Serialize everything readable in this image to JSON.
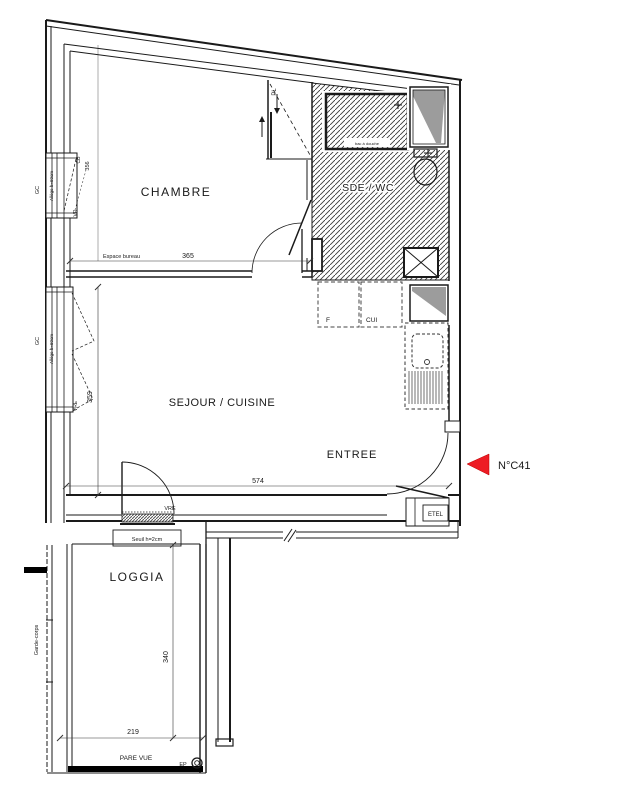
{
  "unit": {
    "arrow_label": "N°C41",
    "arrow_color": "#ed1c24"
  },
  "rooms": {
    "chambre": "CHAMBRE",
    "sde_wc": "SDE / WC",
    "sejour_cuisine": "SEJOUR / CUISINE",
    "entree": "ENTREE",
    "loggia": "LOGGIA"
  },
  "dimensions": {
    "espace_bureau_label": "Espace bureau",
    "chambre_width": "365",
    "sejour_width": "574",
    "sejour_height": "359",
    "chambre_window_height": "356",
    "loggia_height": "340",
    "loggia_width": "219"
  },
  "labels": {
    "pl": "PL",
    "vr": "VR",
    "vre_window": "VRE",
    "vre_door": "VRE",
    "cb": "CB",
    "gc_chambre": "GC",
    "gc_sejour": "GC",
    "allege_chambre": "Allège h=60cm",
    "allege_sejour": "Allège h=60cm",
    "fridge": "F",
    "kitchen_unit": "CUI",
    "etel": "ETEL",
    "seuil": "Seuil h=2cm",
    "pare_vue": "PARE VUE",
    "ep": "EP",
    "garde_corps": "Garde-corps",
    "shower": "bac à douche"
  }
}
